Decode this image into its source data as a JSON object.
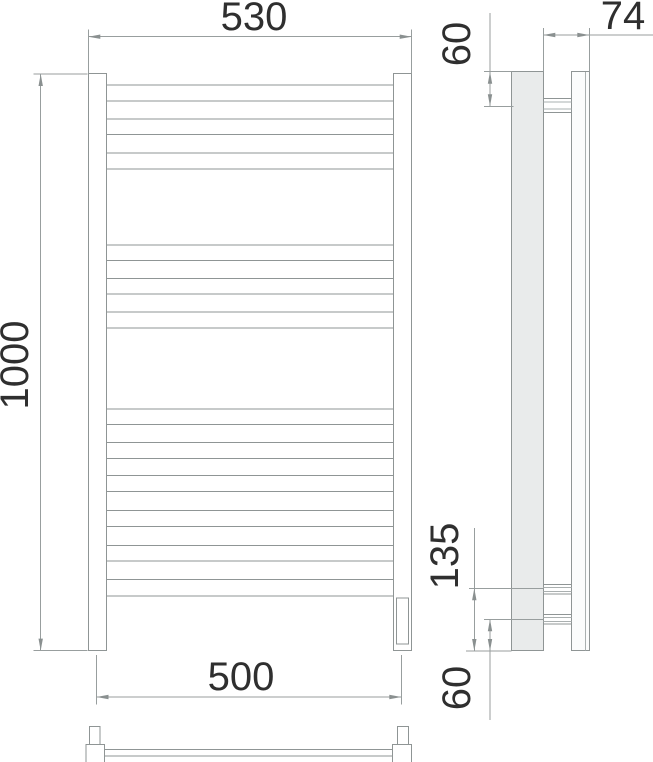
{
  "dimensions": {
    "overall_width": "530",
    "overall_height": "1000",
    "mount_width": "500",
    "depth": "74",
    "top_bracket_offset": "60",
    "lower_bracket_offset": "135",
    "bottom_bracket_offset": "60"
  },
  "structure": {
    "rung_groups": [
      3,
      3,
      6
    ],
    "total_rungs": 12
  }
}
